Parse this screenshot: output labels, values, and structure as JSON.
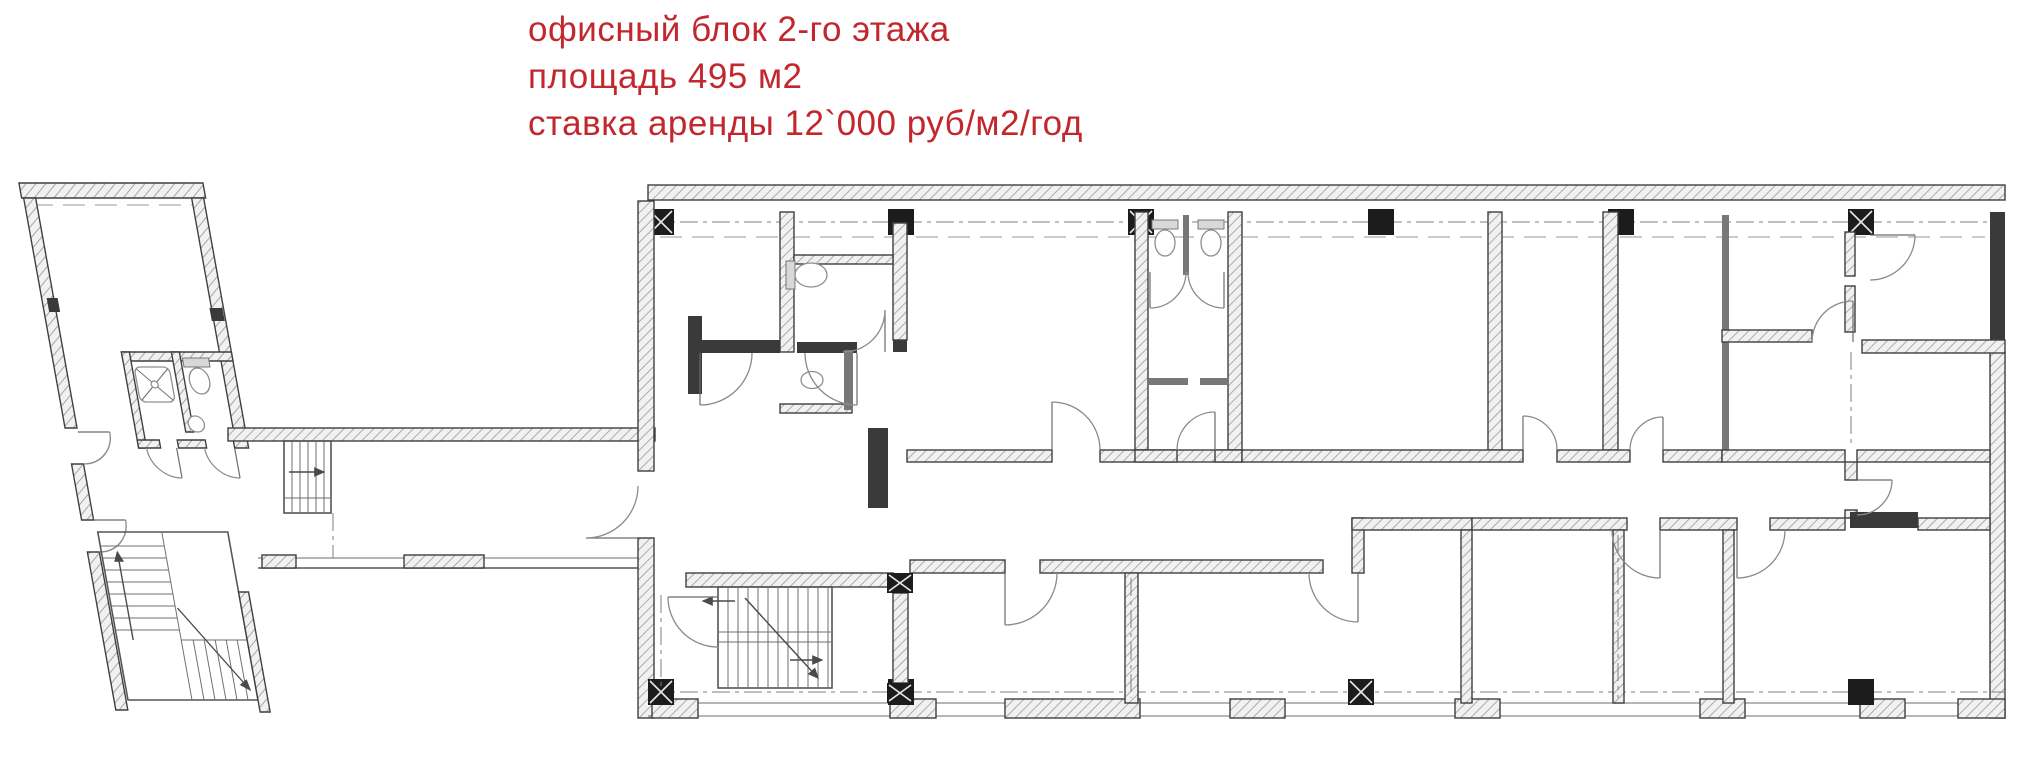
{
  "page": {
    "background": "#ffffff"
  },
  "annotation": {
    "color": "#c1272d",
    "line1": "офисный блок 2-го этажа",
    "line2": "площадь 495 м2",
    "line3": "ставка аренды 12`000 руб/м2/год"
  },
  "plan": {
    "wall_stroke_color": "#3f3f3f",
    "hatch_color": "#9b9b9b",
    "column_color": "#1c1c1c",
    "door_arc_color": "#8a8a8a"
  }
}
